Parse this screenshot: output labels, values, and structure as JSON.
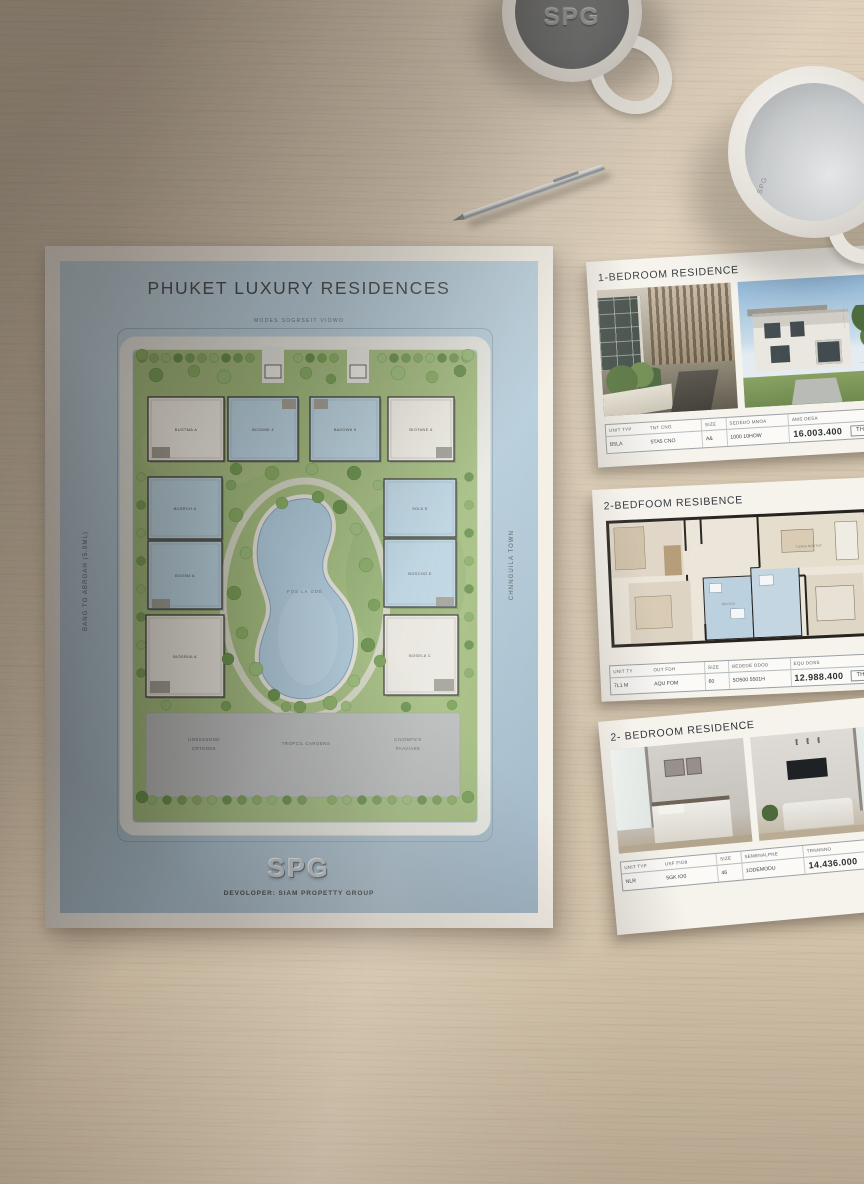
{
  "poster": {
    "title": "PHUKET LUXURY RESIDENCES",
    "subtitle": "MODES SOGRSEIT VIOWO",
    "left_margin_label": "BANG TO ABROAH (5.9ML)",
    "right_margin_label": "CHNNGUILA TOWN",
    "logo": "SPG",
    "developer": "DEVOLOPER: SIAM PROPETTY GROUP",
    "site_plan": {
      "villas_top": [
        "BUSTMA A",
        "BIOOME 4",
        "BAVOW6 5",
        "BIOTANE 6"
      ],
      "villas_left": [
        "BUSRCH A",
        "BOGN4 A",
        "BIOSRU6 A"
      ],
      "villas_right": [
        "5OL6 E",
        "BOSCHO E",
        "BOSEL8 C"
      ],
      "pool_label": "FOS LA ODE",
      "amenities": [
        [
          "UNSSSSOND",
          "CRTDNKE"
        ],
        [
          "TROPCIL CARGENS"
        ],
        [
          "CIUOBFN'S",
          "PAAVIAKE"
        ]
      ]
    }
  },
  "cards": [
    {
      "title": "1-BEDROOM RESIDENCE",
      "headers": [
        "UNIT TYP",
        "TNT CNO",
        "SIZE",
        "SEDEDO MNOA",
        "AMS OESA"
      ],
      "values": [
        "B5LA",
        "5TA5 CNO",
        "A&",
        "1000 10HOW"
      ],
      "price": "16.003.400",
      "currency": "THB"
    },
    {
      "title": "2-BEDFOOM RESIBENCE",
      "headers": [
        "UNIT TY",
        "OUT FDH",
        "SIZE",
        "BEDEDE ODOD",
        "EQU DOSS"
      ],
      "values": [
        "7L1 M",
        "AQU FOM",
        "60",
        "5O500 5501H"
      ],
      "price": "12.988.400",
      "currency": "THB",
      "floorplan": {
        "label_living": "TUVKD ROUTNT",
        "label_bath": "5BA 5UX"
      }
    },
    {
      "title": "2- BEDROOM RESIDENCE",
      "headers": [
        "UNIT TYP",
        "USF FIO8",
        "SIZE",
        "SEMENALPNE",
        "TRNNNNO"
      ],
      "values": [
        "NLR",
        "5GK IO0",
        "46",
        "1ODEMODU"
      ],
      "price": "14.436.000",
      "currency": "THB"
    }
  ],
  "mugs": {
    "top_mug_logo": "SPG",
    "right_mug_text": "SPG"
  }
}
